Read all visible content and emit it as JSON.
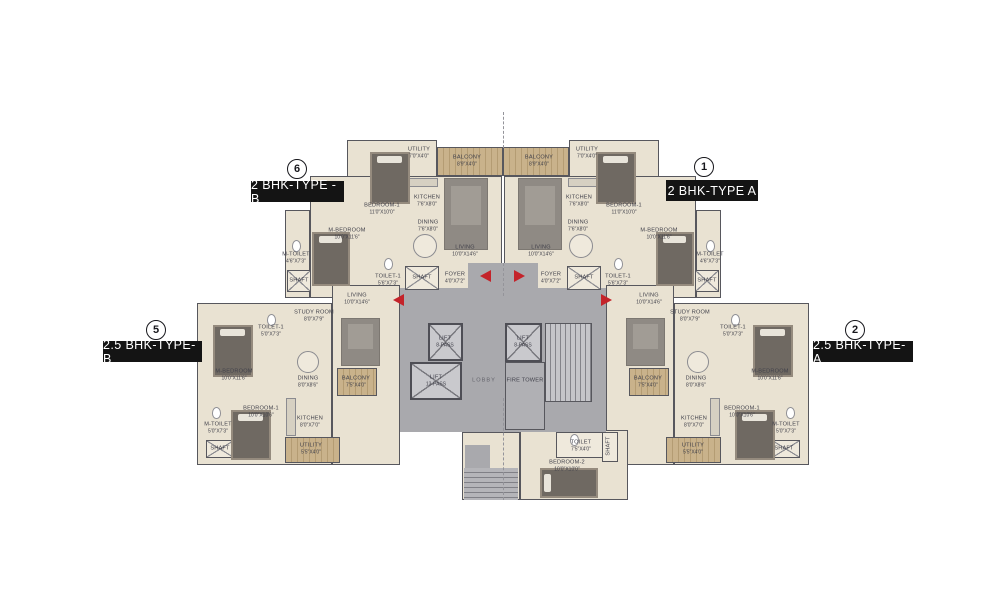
{
  "colors": {
    "background": "#ffffff",
    "wall": "#57575d",
    "floor_beige": "#e9e2d2",
    "floor_light": "#efe9dc",
    "balcony_wood": "#c9b28b",
    "common_gray": "#a9a9ad",
    "lift_gray": "#c9c9cd",
    "carpet_gray": "#8f8a84",
    "bed_dark": "#6f6962",
    "entry_arrow_red": "#c4232a",
    "label_black": "#141414",
    "room_text": "#40404a"
  },
  "unit_labels": [
    {
      "number": "6",
      "label": "2 BHK-TYPE -B",
      "circle": {
        "x": 287,
        "y": 159
      },
      "box": {
        "x": 251,
        "y": 181,
        "w": 93,
        "h": 21
      }
    },
    {
      "number": "1",
      "label": "2 BHK-TYPE A",
      "circle": {
        "x": 694,
        "y": 157
      },
      "box": {
        "x": 666,
        "y": 180,
        "w": 92,
        "h": 21
      }
    },
    {
      "number": "5",
      "label": "2.5 BHK-TYPE-B",
      "circle": {
        "x": 146,
        "y": 320
      },
      "box": {
        "x": 103,
        "y": 341,
        "w": 99,
        "h": 21
      }
    },
    {
      "number": "2",
      "label": "2.5 BHK-TYPE-A",
      "circle": {
        "x": 845,
        "y": 320
      },
      "box": {
        "x": 813,
        "y": 341,
        "w": 100,
        "h": 21
      }
    }
  ],
  "plan": {
    "rooms": [
      {
        "n": "UTILITY",
        "d": "7'0\"X4'0\"",
        "x": 419,
        "y": 153
      },
      {
        "n": "BALCONY",
        "d": "8'9\"X4'0\"",
        "x": 467,
        "y": 161
      },
      {
        "n": "BEDROOM-1",
        "d": "11'0\"X10'0\"",
        "x": 382,
        "y": 209
      },
      {
        "n": "KITCHEN",
        "d": "7'6\"X8'0\"",
        "x": 427,
        "y": 201
      },
      {
        "n": "DINING",
        "d": "7'6\"X8'0\"",
        "x": 428,
        "y": 226
      },
      {
        "n": "LIVING",
        "d": "10'0\"X14'6\"",
        "x": 465,
        "y": 251
      },
      {
        "n": "M-BEDROOM",
        "d": "10'0\"X11'6\"",
        "x": 347,
        "y": 234
      },
      {
        "n": "M-TOILET",
        "d": "4'6\"X7'3\"",
        "x": 296,
        "y": 258
      },
      {
        "n": "SHAFT",
        "d": "",
        "x": 299,
        "y": 281
      },
      {
        "n": "TOILET-1",
        "d": "5'6\"X7'3\"",
        "x": 388,
        "y": 280
      },
      {
        "n": "SHAFT",
        "d": "",
        "x": 422,
        "y": 278
      },
      {
        "n": "FOYER",
        "d": "4'0\"X7'2\"",
        "x": 455,
        "y": 278
      },
      {
        "n": "UTILITY",
        "d": "7'0\"X4'0\"",
        "x": 587,
        "y": 153
      },
      {
        "n": "BALCONY",
        "d": "8'9\"X4'0\"",
        "x": 539,
        "y": 161
      },
      {
        "n": "BEDROOM-1",
        "d": "11'0\"X10'0\"",
        "x": 624,
        "y": 209
      },
      {
        "n": "KITCHEN",
        "d": "7'6\"X8'0\"",
        "x": 579,
        "y": 201
      },
      {
        "n": "DINING",
        "d": "7'6\"X8'0\"",
        "x": 578,
        "y": 226
      },
      {
        "n": "LIVING",
        "d": "10'0\"X14'6\"",
        "x": 541,
        "y": 251
      },
      {
        "n": "M-BEDROOM",
        "d": "10'0\"X11'6\"",
        "x": 659,
        "y": 234
      },
      {
        "n": "M-TOILET",
        "d": "4'6\"X7'3\"",
        "x": 710,
        "y": 258
      },
      {
        "n": "SHAFT",
        "d": "",
        "x": 707,
        "y": 281
      },
      {
        "n": "TOILET-1",
        "d": "5'6\"X7'3\"",
        "x": 618,
        "y": 280
      },
      {
        "n": "SHAFT",
        "d": "",
        "x": 584,
        "y": 278
      },
      {
        "n": "FOYER",
        "d": "4'0\"X7'2\"",
        "x": 551,
        "y": 278
      },
      {
        "n": "LIVING",
        "d": "10'0\"X14'6\"",
        "x": 357,
        "y": 299
      },
      {
        "n": "STUDY ROOM",
        "d": "8'0\"X7'9\"",
        "x": 314,
        "y": 316
      },
      {
        "n": "TOILET-1",
        "d": "5'0\"X7'3\"",
        "x": 271,
        "y": 331
      },
      {
        "n": "M-BEDROOM",
        "d": "10'0\"X11'6\"",
        "x": 234,
        "y": 375
      },
      {
        "n": "DINING",
        "d": "8'0\"X8'6\"",
        "x": 308,
        "y": 382
      },
      {
        "n": "BALCONY",
        "d": "7'5\"X4'0\"",
        "x": 356,
        "y": 382
      },
      {
        "n": "BEDROOM-1",
        "d": "10'0\"X10'6\"",
        "x": 261,
        "y": 412
      },
      {
        "n": "M-TOILET",
        "d": "5'0\"X7'3\"",
        "x": 218,
        "y": 428
      },
      {
        "n": "SHAFT",
        "d": "",
        "x": 220,
        "y": 449
      },
      {
        "n": "KITCHEN",
        "d": "8'0\"X7'0\"",
        "x": 310,
        "y": 422
      },
      {
        "n": "UTILITY",
        "d": "5'5\"X4'0\"",
        "x": 311,
        "y": 449
      },
      {
        "n": "LIVING",
        "d": "10'0\"X14'6\"",
        "x": 649,
        "y": 299
      },
      {
        "n": "STUDY ROOM",
        "d": "8'0\"X7'9\"",
        "x": 690,
        "y": 316
      },
      {
        "n": "TOILET-1",
        "d": "5'0\"X7'3\"",
        "x": 733,
        "y": 331
      },
      {
        "n": "M-BEDROOM",
        "d": "10'0\"X11'6\"",
        "x": 770,
        "y": 375
      },
      {
        "n": "DINING",
        "d": "8'0\"X8'6\"",
        "x": 696,
        "y": 382
      },
      {
        "n": "BALCONY",
        "d": "7'5\"X4'0\"",
        "x": 648,
        "y": 382
      },
      {
        "n": "BEDROOM-1",
        "d": "10'0\"X10'6\"",
        "x": 742,
        "y": 412
      },
      {
        "n": "M-TOILET",
        "d": "5'0\"X7'3\"",
        "x": 786,
        "y": 428
      },
      {
        "n": "SHAFT",
        "d": "",
        "x": 784,
        "y": 449
      },
      {
        "n": "KITCHEN",
        "d": "8'0\"X7'0\"",
        "x": 694,
        "y": 422
      },
      {
        "n": "UTILITY",
        "d": "5'5\"X4'0\"",
        "x": 693,
        "y": 449
      },
      {
        "n": "LIFT",
        "d": "8-PASS",
        "x": 445,
        "y": 342
      },
      {
        "n": "LIFT",
        "d": "13-PASS",
        "x": 436,
        "y": 381
      },
      {
        "n": "LIFT",
        "d": "8-PASS",
        "x": 523,
        "y": 342
      },
      {
        "n": "LOBBY",
        "d": "",
        "x": 484,
        "y": 381,
        "cls": "lobby"
      },
      {
        "n": "FIRE TOWER",
        "d": "",
        "x": 525,
        "y": 381
      },
      {
        "n": "BEDROOM-2",
        "d": "10'0\"X10'0\"",
        "x": 567,
        "y": 466
      },
      {
        "n": "TOILET",
        "d": "7'5\"X4'0\"",
        "x": 581,
        "y": 446
      },
      {
        "n": "SHAFT",
        "d": "",
        "x": 609,
        "y": 446,
        "rot": true
      }
    ],
    "floors": [
      {
        "x": 347,
        "y": 140,
        "w": 90,
        "h": 78
      },
      {
        "x": 310,
        "y": 176,
        "w": 192,
        "h": 122
      },
      {
        "x": 285,
        "y": 210,
        "w": 25,
        "h": 88
      },
      {
        "x": 569,
        "y": 140,
        "w": 90,
        "h": 78
      },
      {
        "x": 504,
        "y": 176,
        "w": 192,
        "h": 122
      },
      {
        "x": 696,
        "y": 210,
        "w": 25,
        "h": 88
      },
      {
        "x": 197,
        "y": 303,
        "w": 135,
        "h": 162
      },
      {
        "x": 332,
        "y": 285,
        "w": 68,
        "h": 180
      },
      {
        "x": 674,
        "y": 303,
        "w": 135,
        "h": 162
      },
      {
        "x": 606,
        "y": 285,
        "w": 68,
        "h": 180
      },
      {
        "x": 520,
        "y": 430,
        "w": 108,
        "h": 70
      },
      {
        "x": 462,
        "y": 432,
        "w": 58,
        "h": 68
      },
      {
        "x": 556,
        "y": 432,
        "w": 48,
        "h": 26,
        "light": true
      },
      {
        "x": 602,
        "y": 432,
        "w": 16,
        "h": 30,
        "light": true
      }
    ],
    "wood": [
      {
        "x": 437,
        "y": 147,
        "w": 66,
        "h": 29
      },
      {
        "x": 503,
        "y": 147,
        "w": 66,
        "h": 29
      },
      {
        "x": 337,
        "y": 368,
        "w": 40,
        "h": 28
      },
      {
        "x": 629,
        "y": 368,
        "w": 40,
        "h": 28
      },
      {
        "x": 285,
        "y": 437,
        "w": 55,
        "h": 26
      },
      {
        "x": 666,
        "y": 437,
        "w": 55,
        "h": 26
      }
    ],
    "gray": [
      {
        "x": 400,
        "y": 288,
        "w": 206,
        "h": 144
      },
      {
        "x": 468,
        "y": 263,
        "w": 70,
        "h": 29
      },
      {
        "x": 465,
        "y": 445,
        "w": 25,
        "h": 55
      }
    ],
    "lift_boxes": [
      {
        "x": 428,
        "y": 323,
        "w": 35,
        "h": 38
      },
      {
        "x": 410,
        "y": 362,
        "w": 52,
        "h": 38
      },
      {
        "x": 505,
        "y": 323,
        "w": 37,
        "h": 39
      }
    ],
    "shaft_boxes": [
      {
        "x": 405,
        "y": 266,
        "w": 34,
        "h": 24
      },
      {
        "x": 567,
        "y": 266,
        "w": 34,
        "h": 24
      },
      {
        "x": 287,
        "y": 270,
        "w": 24,
        "h": 22
      },
      {
        "x": 695,
        "y": 270,
        "w": 24,
        "h": 22
      },
      {
        "x": 206,
        "y": 440,
        "w": 28,
        "h": 18
      },
      {
        "x": 772,
        "y": 440,
        "w": 28,
        "h": 18
      }
    ],
    "fire_tower_room": {
      "x": 505,
      "y": 362,
      "w": 40,
      "h": 68
    },
    "staircase": {
      "x": 545,
      "y": 323,
      "w": 47,
      "h": 79
    },
    "lower_stairs": {
      "x": 464,
      "y": 468,
      "w": 54,
      "h": 32
    },
    "carpets": [
      {
        "x": 444,
        "y": 178,
        "w": 44,
        "h": 72
      },
      {
        "x": 518,
        "y": 178,
        "w": 44,
        "h": 72
      },
      {
        "x": 341,
        "y": 318,
        "w": 39,
        "h": 48
      },
      {
        "x": 626,
        "y": 318,
        "w": 39,
        "h": 48
      }
    ],
    "counters": [
      {
        "x": 406,
        "y": 178,
        "w": 32,
        "h": 9
      },
      {
        "x": 568,
        "y": 178,
        "w": 32,
        "h": 9
      },
      {
        "x": 286,
        "y": 398,
        "w": 10,
        "h": 38
      },
      {
        "x": 710,
        "y": 398,
        "w": 10,
        "h": 38
      }
    ],
    "tables": [
      {
        "x": 413,
        "y": 234,
        "w": 24,
        "h": 24
      },
      {
        "x": 569,
        "y": 234,
        "w": 24,
        "h": 24
      },
      {
        "x": 297,
        "y": 351,
        "w": 22,
        "h": 22
      },
      {
        "x": 687,
        "y": 351,
        "w": 22,
        "h": 22
      }
    ],
    "toilets": [
      {
        "x": 292,
        "y": 240,
        "w": 9,
        "h": 12
      },
      {
        "x": 384,
        "y": 258,
        "w": 9,
        "h": 12
      },
      {
        "x": 706,
        "y": 240,
        "w": 9,
        "h": 12
      },
      {
        "x": 614,
        "y": 258,
        "w": 9,
        "h": 12
      },
      {
        "x": 267,
        "y": 314,
        "w": 9,
        "h": 12
      },
      {
        "x": 212,
        "y": 407,
        "w": 9,
        "h": 12
      },
      {
        "x": 731,
        "y": 314,
        "w": 9,
        "h": 12
      },
      {
        "x": 786,
        "y": 407,
        "w": 9,
        "h": 12
      },
      {
        "x": 570,
        "y": 434,
        "w": 9,
        "h": 12
      }
    ],
    "beds": [
      {
        "x": 370,
        "y": 152,
        "w": 40,
        "h": 52
      },
      {
        "x": 312,
        "y": 232,
        "w": 38,
        "h": 54
      },
      {
        "x": 596,
        "y": 152,
        "w": 40,
        "h": 52
      },
      {
        "x": 656,
        "y": 232,
        "w": 38,
        "h": 54
      },
      {
        "x": 213,
        "y": 325,
        "w": 40,
        "h": 52
      },
      {
        "x": 231,
        "y": 410,
        "w": 40,
        "h": 50
      },
      {
        "x": 753,
        "y": 325,
        "w": 40,
        "h": 52
      },
      {
        "x": 735,
        "y": 410,
        "w": 40,
        "h": 50
      },
      {
        "x": 540,
        "y": 468,
        "w": 58,
        "h": 30,
        "horiz": true
      }
    ],
    "dashes": [
      {
        "x": 503,
        "y": 112,
        "h": 36
      },
      {
        "x": 503,
        "y": 263,
        "h": 33
      },
      {
        "x": 503,
        "y": 398,
        "h": 102
      }
    ],
    "arrows": [
      {
        "x": 486,
        "y": 276,
        "dir": "left"
      },
      {
        "x": 520,
        "y": 276,
        "dir": "right"
      },
      {
        "x": 399,
        "y": 300,
        "dir": "left"
      },
      {
        "x": 607,
        "y": 300,
        "dir": "right"
      }
    ]
  }
}
